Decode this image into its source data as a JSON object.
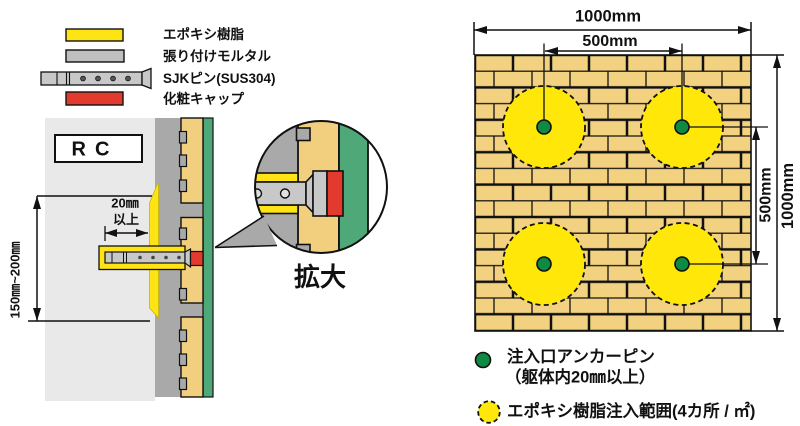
{
  "materials_legend": {
    "items": [
      {
        "name": "epoxy-resin",
        "label": "エポキシ樹脂"
      },
      {
        "name": "bonding-mortar",
        "label": "張り付けモルタル"
      },
      {
        "name": "sjk-pin",
        "label": "SJKピン(SUS304)"
      },
      {
        "name": "decorative-cap",
        "label": "化粧キャップ"
      }
    ]
  },
  "cross_section": {
    "rc_label": "RC",
    "embed_depth_line1": "20㎜",
    "embed_depth_line2": "以上",
    "pitch_range_label": "150㎜~200㎜",
    "detail_label": "拡大"
  },
  "injection_plan": {
    "dim_width_total": "1000mm",
    "dim_width_half": "500mm",
    "dim_height_half": "500mm",
    "dim_height_total": "1000mm"
  },
  "plan_legend": {
    "anchor_pin_line1": "注入口アンカーピン",
    "anchor_pin_line2": "（躯体内20㎜以上）",
    "epoxy_range_label": "エポキシ樹脂注入範囲(4カ所 / ㎡)"
  },
  "colors": {
    "epoxy_yellow": "#FFE415",
    "injection_circle_yellow": "#FFE70A",
    "bonding_mortar_gray": "#A9A9A9",
    "legend_mortar_gray": "#BFBFBF",
    "rc_concrete_gray": "#E9E9E9",
    "tile_tan": "#F2CF7E",
    "brick_tan": "#F2D180",
    "surface_green": "#4EA877",
    "anchor_pin_green": "#0F8A42",
    "cap_red": "#E23B2E",
    "pin_gray": "#C8C8C8"
  }
}
